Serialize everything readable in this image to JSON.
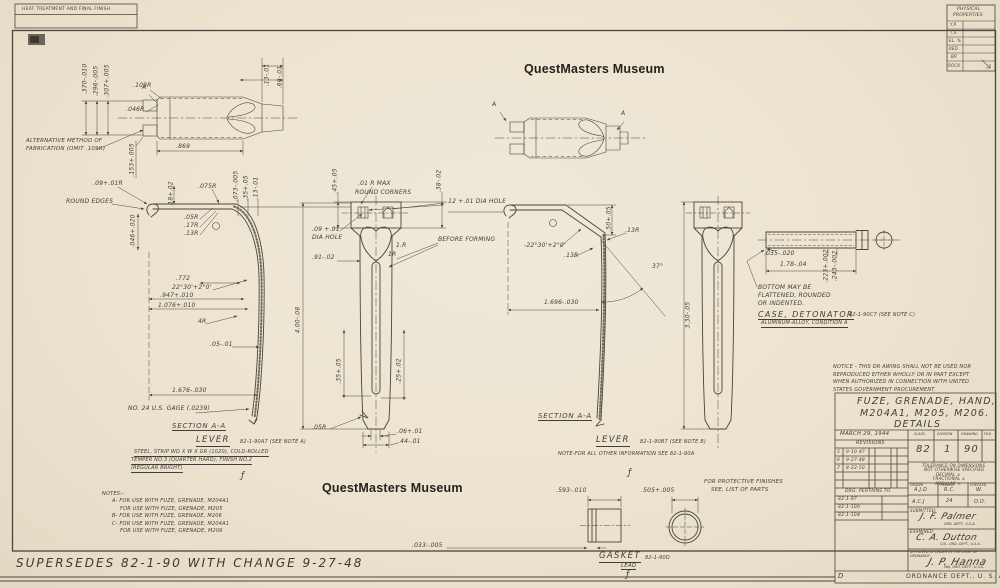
{
  "colors": {
    "paper": "#ece3d0",
    "ink": "#4a443a",
    "watermark": "#25221d"
  },
  "watermarks": {
    "top": "QuestMasters Museum",
    "bottom": "QuestMasters Museum"
  },
  "heat_box": {
    "line1": "HEAT TREATMENT AND FINAL FINISH"
  },
  "physical_properties": {
    "title_line1": "PHYSICAL",
    "title_line2": "PROPERTIES",
    "rows": [
      "Y.P.",
      "T.S.",
      "EL. %",
      "RED.",
      "BR",
      "ROCK"
    ]
  },
  "supersedes": "SUPERSEDES 82-1-90 WITH CHANGE 9-27-48",
  "notes": {
    "header": "NOTES:-",
    "lines": [
      "A- FOR USE WITH FUZE, GRENADE, M204A1",
      "FOR USE WITH FUZE, GRENADE, M205",
      "B- FOR USE WITH FUZE, GRENADE, M206",
      "C- FOR USE WITH FUZE, GRENADE, M204A1",
      "FOR USE WITH FUZE, GRENADE, M206"
    ]
  },
  "notice": {
    "line1": "NOTICE - THIS DR AWING SHALL NOT BE USED NOR",
    "line2": "REPRODUCED EITHER WHOLLY OR IN PART EXCEPT",
    "line3": "WHEN AUTHORIZED IN CONNECTION WITH UNITED",
    "line4": "STATES GOVERNMENT PROCUREMENT."
  },
  "titles": {
    "lever_a_word": "LEVER",
    "lever_a_ref": "82-1-90A7 (SEE NOTE A)",
    "lever_a_mat1": "STEEL, STRIP WD X W X GR (1020), COLD-ROLLED",
    "lever_a_mat2": "TEMPER NO.3 (QUARTER HARD), FINISH NO.2",
    "lever_a_mat3": "(REGULAR BRIGHT)",
    "lever_b_word": "LEVER",
    "lever_b_ref": "82-1-90B7 (SEE NOTE B)",
    "lever_b_note": "NOTE-FOR ALL OTHER INFORMATION SEE 82-1-90A",
    "case_word": "CASE, DETONATOR",
    "case_ref": "82-1-90C7 (SEE NOTE C)",
    "case_mat": "ALUMINUM-ALLOY, CONDITION A",
    "case_note1": "BOTTOM MAY BE",
    "case_note2": "FLATTENED, ROUNDED",
    "case_note3": "OR INDENTED.",
    "gasket_word": "GASKET",
    "gasket_ref": "82-1-90D",
    "gasket_mat": "LEAD",
    "protective1": "FOR PROTECTIVE FINISHES",
    "protective2": "SEE, LIST OF PARTS",
    "alt_note1": "ALTERNATIVE METHOD OF",
    "alt_note2": "FABRICATION (OMIT .109R)",
    "marker_a": "A",
    "finish_mark": "ƒ"
  },
  "dims": {
    "alt_d370": ".370-.010",
    "alt_d296": ".296-.005",
    "alt_d307": ".307+.005",
    "alt_r109": ".109R",
    "alt_r046": ".046R",
    "alt_d153": ".153+.005",
    "alt_d869": ".869",
    "alt_d13": ".13-.01",
    "alt_d69": ".69-.01",
    "ls_r09": ".09+.01R",
    "ls_round": "ROUND EDGES",
    "ls_d046": ".046+.020",
    "ls_r075": ".075R",
    "ls_d18": ".18+.02",
    "ls_d073": ".073-.005",
    "ls_d35": ".35+.05",
    "ls_d13": ".13-.01",
    "ls_r05": ".05R",
    "ls_r17": ".17R",
    "ls_r13": ".13R",
    "ls_d772": ".772",
    "ls_ang": "22°30'+2°0'",
    "ls_d947": ".947+.010",
    "ls_d1076": "1.076+.010",
    "ls_r4": "4R",
    "ls_d05": ".05-.01",
    "ls_d1676": "1.676-.030",
    "ls_gage": "NO. 24 U.S. GAGE (.0239)",
    "ls_section": "SECTION A-A",
    "ml_d45": ".45+.05",
    "ml_rmax1": ".01 R MAX",
    "ml_rmax2": "ROUND CORNERS",
    "ml_d38": ".38-.02",
    "ml_hole12": ".12 +.01 DIA HOLE",
    "ml_hole09a": ".09 +.01",
    "ml_hole09b": "DIA HOLE",
    "ml_before": "BEFORE FORMING",
    "ml_1ra": "1.R",
    "ml_1rb": "1R",
    "ml_d91": ".91-.02",
    "ml_d400": "4.00-.08",
    "ml_d35": ".35+.05",
    "ml_d25": ".25+.02",
    "ml_r05": ".05R",
    "ml_d06": ".06+.01",
    "ml_d44": ".44-.01",
    "rs_ang": "-22°30'+2°0'",
    "rs_d50": ".50+.05",
    "rs_r13a": ".13R",
    "rs_r13b": ".13R",
    "rs_deg37": "37°",
    "rs_d1696": "1.696-.030",
    "rl_d330": "3.30-.05",
    "rs_section": "SECTION A-A",
    "det_d035": ".035-.020",
    "det_d178": "1.78-.04",
    "det_d223": ".223+.002",
    "det_d243": ".243-.002",
    "gsk_d593": ".593-.010",
    "gsk_d505": ".505+.005",
    "gsk_d033": ".033-.005"
  },
  "title_block": {
    "title1": "FUZE, GRENADE, HAND,",
    "title2": "M204A1, M205, M206.",
    "title3": "DETAILS",
    "date": "MARCH 29, 1944",
    "revisions_label": "REVISIONS",
    "revisions": [
      [
        "5",
        "9-10-47"
      ],
      [
        "6",
        "9-27-48"
      ],
      [
        "7",
        "8-22-50"
      ]
    ],
    "class_label": "CLASS",
    "class_value": "82",
    "division_label": "DIVISION",
    "division_value": "1",
    "drawing_label": "DRAWING",
    "drawing_value": "90",
    "file_label": "FILE-",
    "tolerance1": "TOLERANCE ON DIMENSIONS",
    "tolerance2": "NOT OTHERWISE SPECIFIED",
    "tolerance3": "DECIMAL ±",
    "tolerance4": "FRACTIONAL ±",
    "tolerance5": "ANGULAR ±",
    "pertains_label": "DRG. PERTAINS TO",
    "pertains": [
      "82-1-87",
      "82-1-100",
      "82-1-104"
    ],
    "cell_labels": [
      "DRAWN",
      "TRACED",
      "CHECKED"
    ],
    "cell_values_row1": [
      "A.J.D",
      "R.C.",
      "W."
    ],
    "cell_values_row2": [
      "A.C.J",
      "24",
      "O.O."
    ],
    "submitted_label": "SUBMITTED:",
    "submitted_sig": "J. F. Palmer",
    "submitted_org": "ORD. DEPT., U.S.A.",
    "examined_label": "EXAMINED:",
    "examined_sig": "C. A. Dutton",
    "examined_org": "COL. ORD. DEPT., U.S.A.",
    "approved_label1": "APPROVED BY ORDER OF THE CHIEF OF",
    "approved_label2": "ORDNANCE:",
    "approved_sig": "J. P. Hanna",
    "approved_org": "MAJ. ORD. DEPT., U.S.A.",
    "dept": "ORDNANCE DEPT., U. S. A.",
    "zone": "D"
  }
}
